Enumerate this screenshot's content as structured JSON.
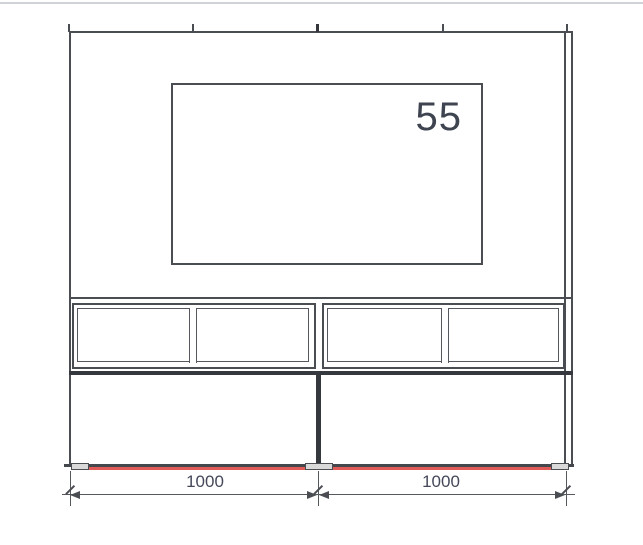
{
  "drawing": {
    "title": "TV wall unit elevation",
    "tv_label": "55",
    "dimensions": [
      {
        "label": "1000"
      },
      {
        "label": "1000"
      }
    ],
    "colors": {
      "line": "#4a4d52",
      "thick_line": "#35383d",
      "baseline_highlight": "#e05a58",
      "dimension_text": "#44485a",
      "foot_fill": "#d9d9d9"
    },
    "shelf_compartments": 4,
    "top_tick_count": 5
  }
}
